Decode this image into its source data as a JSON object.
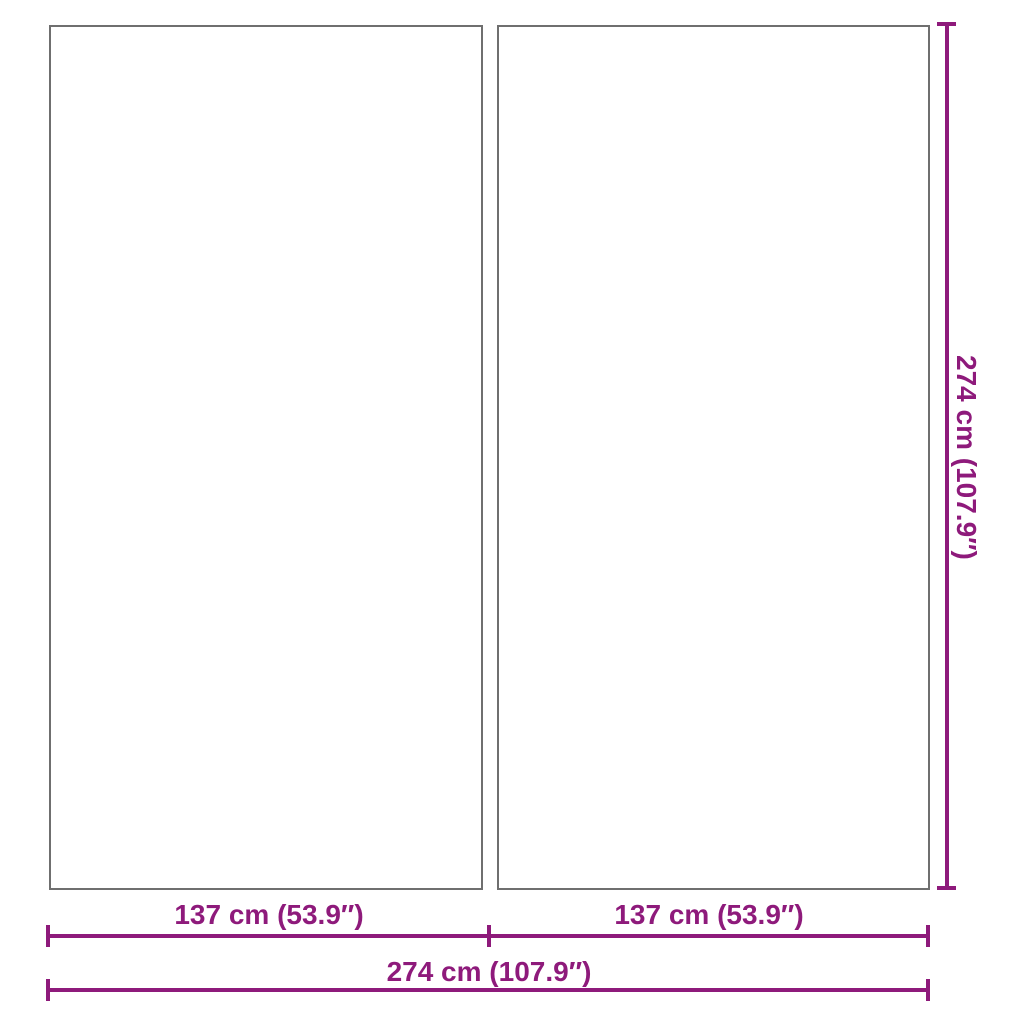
{
  "colors": {
    "dimension": "#8E1A7B",
    "panel_border": "#6F6F6F",
    "background": "#FFFFFF"
  },
  "panels": [
    {
      "name": "left-panel"
    },
    {
      "name": "right-panel"
    }
  ],
  "dimensions": {
    "height": {
      "label": "274 cm (107.9″)",
      "orientation": "vertical"
    },
    "panel_width_left": {
      "label": "137 cm (53.9″)",
      "orientation": "horizontal"
    },
    "panel_width_right": {
      "label": "137 cm (53.9″)",
      "orientation": "horizontal"
    },
    "total_width": {
      "label": "274 cm (107.9″)",
      "orientation": "horizontal"
    }
  }
}
